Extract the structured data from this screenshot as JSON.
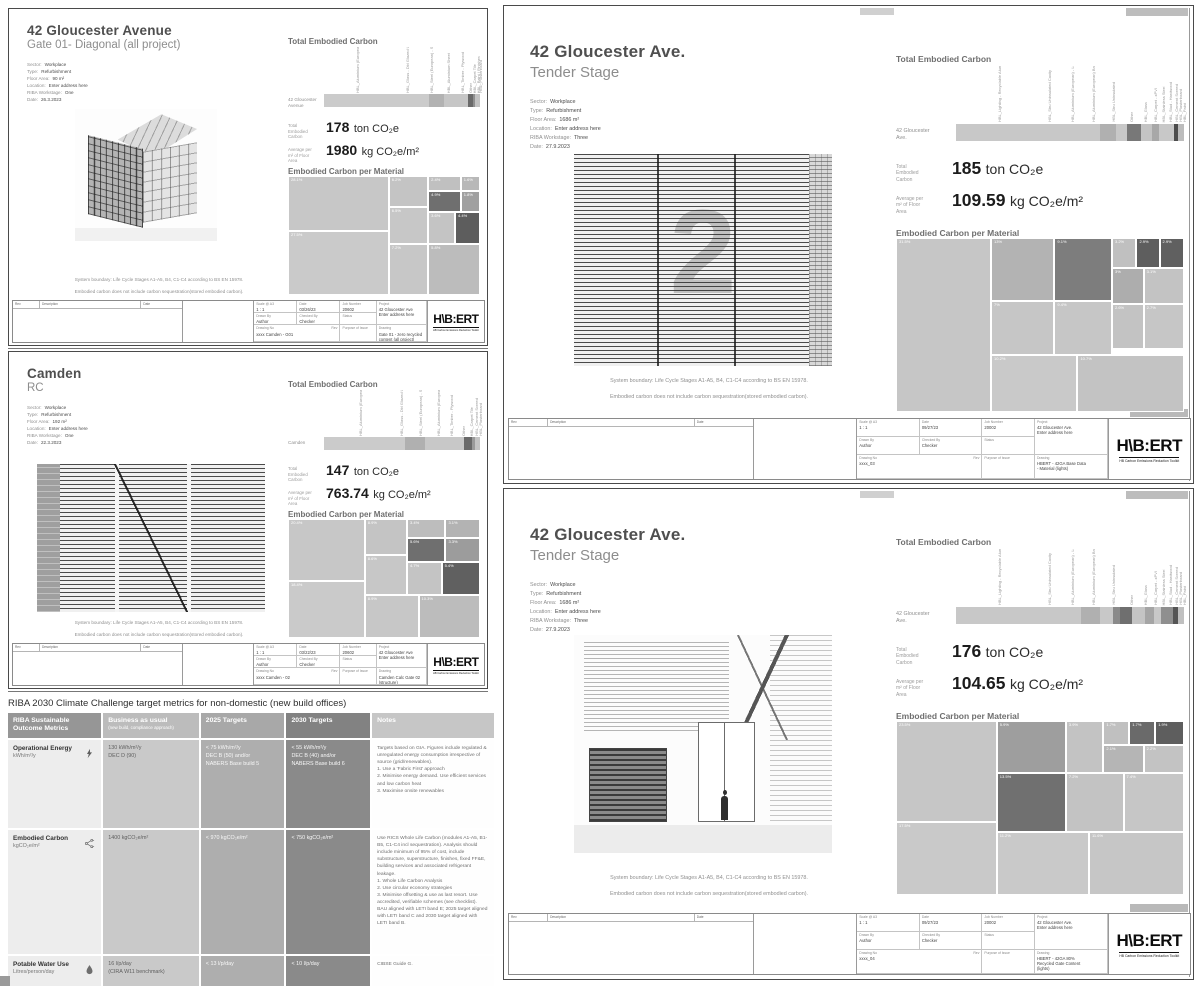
{
  "logo": {
    "text": "H\\B:ERT",
    "tagline": "HB Carbon Emissions Reduction Toolkit"
  },
  "strings": {
    "total_heading": "Total Embodied Carbon",
    "material_heading": "Embodied Carbon per Material",
    "total_label": "Total\nEmbodied\nCarbon",
    "avg_label": "Average per\nm² of Floor\nArea",
    "boundary1": "System boundary: Life Cycle Stages A1-A5, B4, C1-C4 according to BS EN 15978.",
    "boundary2": "Embodied carbon does not include carbon sequestration(stored embodied carbon)."
  },
  "tb_labels": {
    "scale": "Scale @ A3",
    "date": "Date",
    "job": "Job Number",
    "project": "Project",
    "drawn": "Drawn By",
    "checked": "Checked By",
    "status": "Status",
    "dno": "Drawing No",
    "rev": "Rev",
    "poi": "Purpose of Issue",
    "drawing": "Drawing",
    "rev_head": [
      "Rev",
      "Description",
      "Date"
    ]
  },
  "reports": [
    {
      "title": "42 Gloucester Avenue",
      "subtitle": "Gate 01-  Diagonal (all project)",
      "art_glyph": "",
      "meta": [
        [
          "Sector:",
          "Workplace"
        ],
        [
          "Type:",
          "Refurbishment"
        ],
        [
          "Floor Area:",
          "90 m²"
        ],
        [
          "Location:",
          "Enter address here"
        ],
        [
          "RIBA Workstage:",
          "One"
        ],
        [
          "Date:",
          "26.3.2023"
        ]
      ],
      "totals": {
        "value": "178",
        "value_unit": "ton CO₂e",
        "avg": "1980",
        "avg_unit": "kg CO₂e/m²"
      },
      "bar": {
        "label": "42 Gloucester Avenue",
        "segments": [
          [
            67,
            "#cbcbcb"
          ],
          [
            10,
            "#b2b2b2"
          ],
          [
            15,
            "#c6c6c6"
          ],
          [
            3.5,
            "#6a6a6a"
          ],
          [
            1.5,
            "#8f8f8f"
          ],
          [
            3,
            "#c2c2c2"
          ]
        ],
        "ticks": [
          [
            20,
            "HBL_Aluminium (European) - Louvre"
          ],
          [
            52,
            "HBL_Glass - Dbl Glazed Unit"
          ],
          [
            67,
            "HBL_Steel (European) - S355"
          ],
          [
            78,
            "HBL_Aluminium Sheet"
          ],
          [
            87,
            "HBL_Timber - Plywood"
          ],
          [
            92,
            "Other"
          ],
          [
            95,
            "HBL_Carpet Tile"
          ],
          [
            97.5,
            "HBL_Paint / Finishes"
          ],
          [
            99,
            "HBL_Plasterboard"
          ]
        ]
      },
      "treemap": [
        [
          0,
          0,
          52.5,
          46,
          "#c7c7c7",
          "28.1%"
        ],
        [
          0,
          46,
          52.5,
          54,
          "#cacaca",
          "27.5%"
        ],
        [
          52.5,
          0,
          20.5,
          26,
          "#c4c4c4",
          "6.2%"
        ],
        [
          73,
          0,
          17,
          13,
          "#c0c0c0",
          "2.4%"
        ],
        [
          90,
          0,
          10,
          13,
          "#b8b8b8",
          "1.6%"
        ],
        [
          73,
          13,
          17,
          17,
          "#6f6f6f",
          "4.9%"
        ],
        [
          90,
          13,
          10,
          17,
          "#a0a0a0",
          "1.8%"
        ],
        [
          52.5,
          26,
          20.5,
          31,
          "#c7c7c7",
          "6.5%"
        ],
        [
          73,
          30,
          14,
          27,
          "#c4c4c4",
          "3.6%"
        ],
        [
          87,
          30,
          13,
          27,
          "#5d5d5d",
          "4.4%"
        ],
        [
          52.5,
          57,
          20.5,
          43,
          "#c7c7c7",
          "7.2%"
        ],
        [
          73,
          57,
          27,
          43,
          "#bcbcbc",
          "5.8%"
        ]
      ],
      "titleblock": {
        "scale": "1 : 1",
        "date": "03/26/23",
        "job": "20602",
        "project": "42 Gloucester Ave",
        "address": "Enter address here",
        "drawn": "Author",
        "checked": "Checker",
        "drawing_no": "xxxx Camden - G01",
        "drawing_title": "Gate 01 - zero recycled\ncontent (all project)"
      }
    },
    {
      "title": "Camden",
      "subtitle": "RC",
      "art_glyph": "",
      "meta": [
        [
          "Sector:",
          "Workplace"
        ],
        [
          "Type:",
          "Refurbishment"
        ],
        [
          "Floor Area:",
          "192 m²"
        ],
        [
          "Location:",
          "Enter address here"
        ],
        [
          "RIBA Workstage:",
          "One"
        ],
        [
          "Date:",
          "22.3.2023"
        ]
      ],
      "totals": {
        "value": "147",
        "value_unit": "ton CO₂e",
        "avg": "763.74",
        "avg_unit": "kg CO₂e/m²"
      },
      "bar": {
        "label": "Camden",
        "segments": [
          [
            52,
            "#cbcbcb"
          ],
          [
            13,
            "#b0b0b0"
          ],
          [
            25,
            "#c8c8c8"
          ],
          [
            5,
            "#6a6a6a"
          ],
          [
            2,
            "#9a9a9a"
          ],
          [
            3,
            "#c4c4c4"
          ]
        ],
        "ticks": [
          [
            22,
            "HBL_Aluminium (European) - Louvre"
          ],
          [
            48,
            "HBL_Glass - Dbl Glazed Unit"
          ],
          [
            60,
            "HBL_Steel (European) - S355"
          ],
          [
            72,
            "HBL_Aluminium (European) Brackets"
          ],
          [
            80,
            "HBL_Timber - Plywood"
          ],
          [
            88,
            "Other"
          ],
          [
            93,
            "HBL_Carpet Tile"
          ],
          [
            96,
            "HBL_Cement Screed"
          ],
          [
            98.5,
            "HBL_Plasterboard"
          ]
        ]
      },
      "treemap": [
        [
          0,
          0,
          40,
          52,
          "#c7c7c7",
          "20.4%"
        ],
        [
          0,
          52,
          40,
          48,
          "#cacaca",
          "18.4%"
        ],
        [
          40,
          0,
          22,
          30,
          "#c4c4c4",
          "8.9%"
        ],
        [
          62,
          0,
          20,
          16,
          "#bdbdbd",
          "3.4%"
        ],
        [
          82,
          0,
          18,
          16,
          "#b3b3b3",
          "3.1%"
        ],
        [
          62,
          16,
          20,
          20,
          "#6f6f6f",
          "5.6%"
        ],
        [
          82,
          16,
          18,
          20,
          "#9c9c9c",
          "3.3%"
        ],
        [
          40,
          30,
          22,
          34,
          "#c7c7c7",
          "8.6%"
        ],
        [
          62,
          36,
          18,
          28,
          "#c4c4c4",
          "4.7%"
        ],
        [
          80,
          36,
          20,
          28,
          "#606060",
          "5.4%"
        ],
        [
          40,
          64,
          28,
          36,
          "#c7c7c7",
          "8.9%"
        ],
        [
          68,
          64,
          32,
          36,
          "#bcbcbc",
          "10.3%"
        ]
      ],
      "titleblock": {
        "scale": "1 : 1",
        "date": "03/22/23",
        "job": "20602",
        "project": "42 Gloucester Ave",
        "address": "Enter address here",
        "drawn": "Author",
        "checked": "Checker",
        "drawing_no": "xxxx Camden - 02",
        "drawing_title": "Camden Calc Gate 02\n(structure)"
      }
    },
    {
      "title": "42 Gloucester Ave.",
      "subtitle": "Tender Stage",
      "art_glyph": "2",
      "meta": [
        [
          "Sector:",
          "Workplace"
        ],
        [
          "Type:",
          "Refurbishment"
        ],
        [
          "Floor Area:",
          "1686 m²"
        ],
        [
          "Location:",
          "Enter address here"
        ],
        [
          "RIBA Workstage:",
          "Three"
        ],
        [
          "Date:",
          "27.9.2023"
        ]
      ],
      "totals": {
        "value": "185",
        "value_unit": "ton CO₂e",
        "avg": "109.59",
        "avg_unit": "kg CO₂e/m²"
      },
      "bar": {
        "label": "42 Gloucester\nAve.",
        "segments": [
          [
            63,
            "#c8c8c8"
          ],
          [
            7,
            "#b0b0b0"
          ],
          [
            5,
            "#c8c8c8"
          ],
          [
            6,
            "#787878"
          ],
          [
            5,
            "#c4c4c4"
          ],
          [
            3,
            "#a8a8a8"
          ],
          [
            6.5,
            "#c8c8c8"
          ],
          [
            1.8,
            "#4d4d4d"
          ],
          [
            2.7,
            "#bcbcbc"
          ]
        ],
        "ticks": [
          [
            18,
            "HBL_Lighting - Recyclable Aluminium LED"
          ],
          [
            40,
            "HBL_Stru Uninsulated Cavity"
          ],
          [
            50,
            "HBL_Aluminium (European) - Louvres"
          ],
          [
            59,
            "HBL_Aluminium (European) Brackets"
          ],
          [
            68,
            "HBL_Stru Uninsulated"
          ],
          [
            76,
            "Other"
          ],
          [
            82,
            "HBL_Glass"
          ],
          [
            86.5,
            "HBL_Carpet - xPVI"
          ],
          [
            90,
            "HBL_Stainless Steel"
          ],
          [
            93,
            "HBL_Stud - Hardwood"
          ],
          [
            95.5,
            "HBL_Cement Screed"
          ],
          [
            97.5,
            "HBL_Plasterboard"
          ],
          [
            99,
            "HBL_Paint"
          ]
        ]
      },
      "treemap": [
        [
          0,
          0,
          33,
          100,
          "#c6c6c6",
          "31.5%"
        ],
        [
          33,
          0,
          22,
          36,
          "#b3b3b3",
          "13%"
        ],
        [
          55,
          0,
          20,
          36,
          "#7d7d7d",
          "9.1%"
        ],
        [
          75,
          0,
          8.5,
          17,
          "#c0c0c0",
          "3.2%"
        ],
        [
          83.5,
          0,
          8,
          17,
          "#5e5e5e",
          "2.9%"
        ],
        [
          91.5,
          0,
          8.5,
          17,
          "#606060",
          "2.9%"
        ],
        [
          75,
          17,
          11,
          21,
          "#adadad",
          "3%"
        ],
        [
          86,
          17,
          14,
          21,
          "#c3c3c3",
          "3.1%"
        ],
        [
          33,
          36,
          22,
          31,
          "#c6c6c6",
          "7%"
        ],
        [
          55,
          36,
          20,
          31,
          "#c6c6c6",
          "9.4%"
        ],
        [
          75,
          38,
          11,
          26,
          "#c3c3c3",
          "2.6%"
        ],
        [
          86,
          38,
          14,
          26,
          "#c6c6c6",
          "2.7%"
        ],
        [
          33,
          67,
          30,
          33,
          "#c9c9c9",
          "10.2%"
        ],
        [
          63,
          67,
          37,
          33,
          "#c3c3c3",
          "10.7%"
        ]
      ],
      "titleblock": {
        "scale": "1 : 1",
        "date": "09/27/23",
        "job": "20002",
        "project": "42 Gloucester Ave.",
        "address": "Enter address here",
        "drawn": "Author",
        "checked": "Checker",
        "drawing_no": "xxxx_03",
        "drawing_title": "HBERT - 42GA Base Data\n- Material (lights)"
      }
    },
    {
      "title": "42 Gloucester Ave.",
      "subtitle": "Tender Stage",
      "art_glyph": "",
      "meta": [
        [
          "Sector:",
          "Workplace"
        ],
        [
          "Type:",
          "Refurbishment"
        ],
        [
          "Floor Area:",
          "1686 m²"
        ],
        [
          "Location:",
          "Enter address here"
        ],
        [
          "RIBA Workstage:",
          "Three"
        ],
        [
          "Date:",
          "27.9.2023"
        ]
      ],
      "totals": {
        "value": "176",
        "value_unit": "ton CO₂e",
        "avg": "104.65",
        "avg_unit": "kg CO₂e/m²"
      },
      "bar": {
        "label": "42 Gloucester\nAve.",
        "segments": [
          [
            55,
            "#c8c8c8"
          ],
          [
            8,
            "#b0b0b0"
          ],
          [
            6,
            "#c8c8c8"
          ],
          [
            3,
            "#8a8a8a"
          ],
          [
            5,
            "#6f6f6f"
          ],
          [
            6,
            "#c4c4c4"
          ],
          [
            4,
            "#a5a5a5"
          ],
          [
            3,
            "#c8c8c8"
          ],
          [
            5,
            "#8f8f8f"
          ],
          [
            2.5,
            "#555555"
          ],
          [
            2.5,
            "#c0c0c0"
          ]
        ],
        "ticks": [
          [
            18,
            "HBL_Lighting - Recyclable Aluminium LED"
          ],
          [
            40,
            "HBL_Stru Uninsulated Cavity"
          ],
          [
            50,
            "HBL_Aluminium (European) - Louvres"
          ],
          [
            59,
            "HBL_Aluminium (European) Brackets"
          ],
          [
            68,
            "HBL_Stru Uninsulated"
          ],
          [
            76,
            "Other"
          ],
          [
            82,
            "HBL_Glass"
          ],
          [
            86.5,
            "HBL_Carpet - xPVI"
          ],
          [
            90,
            "HBL_Stainless Steel"
          ],
          [
            93,
            "HBL_Stud - Hardwood"
          ],
          [
            95.5,
            "HBL_Cement Screed"
          ],
          [
            97.5,
            "HBL_Plasterboard"
          ],
          [
            99,
            "HBL_Paint"
          ]
        ]
      },
      "treemap": [
        [
          0,
          0,
          35,
          58,
          "#c6c6c6",
          "23.5%"
        ],
        [
          0,
          58,
          35,
          42,
          "#c9c9c9",
          "17.5%"
        ],
        [
          35,
          0,
          24,
          30,
          "#9e9e9e",
          "5.9%"
        ],
        [
          59,
          0,
          13,
          30,
          "#c3c3c3",
          "3.9%"
        ],
        [
          72,
          0,
          9,
          14,
          "#c0c0c0",
          "1.7%"
        ],
        [
          81,
          0,
          9,
          14,
          "#6a6a6a",
          "1.7%"
        ],
        [
          90,
          0,
          10,
          14,
          "#5e5e5e",
          "1.9%"
        ],
        [
          72,
          14,
          14,
          16,
          "#b5b5b5",
          "2.1%"
        ],
        [
          86,
          14,
          14,
          16,
          "#c3c3c3",
          "2.2%"
        ],
        [
          35,
          30,
          24,
          34,
          "#707070",
          "13.5%"
        ],
        [
          59,
          30,
          20,
          34,
          "#c3c3c3",
          "7.2%"
        ],
        [
          79,
          30,
          21,
          34,
          "#c6c6c6",
          "7.4%"
        ],
        [
          35,
          64,
          32,
          36,
          "#c9c9c9",
          "11.2%"
        ],
        [
          67,
          64,
          33,
          36,
          "#c6c6c6",
          "11.6%"
        ]
      ],
      "titleblock": {
        "scale": "1 : 1",
        "date": "09/27/23",
        "job": "20002",
        "project": "42 Gloucester Ave.",
        "address": "Enter address here",
        "drawn": "Author",
        "checked": "Checker",
        "drawing_no": "xxxx_04",
        "drawing_title": "HBERT - 42GA 80%\nRecycled Gate Content\n(lights)"
      }
    }
  ],
  "riba": {
    "title": "RIBA 2030 Climate Challenge target metrics for non-domestic (new build offices)",
    "header_colors": [
      "#969696",
      "#bcbcbc",
      "#a8a8a8",
      "#828282",
      "#c6c6c6"
    ],
    "headers": [
      {
        "main": "RIBA Sustainable Outcome Metrics",
        "sub": ""
      },
      {
        "main": "Business as usual",
        "sub": "(new build, compliance approach)"
      },
      {
        "main": "2025 Targets",
        "sub": ""
      },
      {
        "main": "2030 Targets",
        "sub": ""
      },
      {
        "main": "Notes",
        "sub": ""
      }
    ],
    "rows": [
      {
        "metric": "Operational Energy",
        "unit": "kWh/m²/y",
        "icon": "lightning-icon",
        "bau": "130 kWh/m²/y\nDEC D (90)",
        "t2025": "< 75 kWh/m²/y\nDEC B (50) and/or\nNABERS Base build 5",
        "t2030": "< 55 kWh/m²/y\nDEC B (40) and/or\nNABERS Base build 6",
        "notes": "Targets based on GIA. Figures include regulated & unregulated energy consumption irrespective of source (grid/renewables).\n1.  Use a 'Fabric First' approach\n2.  Minimise energy demand. Use efficient services and low carbon heat\n3.  Maximise onsite renewables"
      },
      {
        "metric": "Embodied Carbon",
        "unit": "kgCO₂e/m²",
        "icon": "molecule-icon",
        "bau": "1400 kgCO₂e/m²",
        "t2025": "< 970 kgCO₂e/m²",
        "t2030": "< 750 kgCO₂e/m²",
        "notes": "Use RICS Whole Life Carbon (modules A1-A5, B1-B5, C1-C4 incl sequestration). Analysis should include minimum of 95% of cost, include substructure, superstructure, finishes, fixed FF&E, building services and associated refrigerant leakage.\n1.  Whole Life Carbon Analysis\n2.  Use circular economy strategies\n3.  Minimise offsetting & use as last resort. Use accredited, verifiable schemes (see checklist).\nBAU aligned with LETI band E; 2025 target aligned with LETI band C and 2030 target aligned with LETI band B."
      },
      {
        "metric": "Potable Water Use",
        "unit": "Litres/person/day",
        "icon": "drop-icon",
        "bau": "16 l/p/day\n(CIRA W11 benchmark)",
        "t2025": "< 13 l/p/day",
        "t2030": "< 10 l/p/day",
        "notes": "CIBSE Guide G."
      }
    ]
  }
}
